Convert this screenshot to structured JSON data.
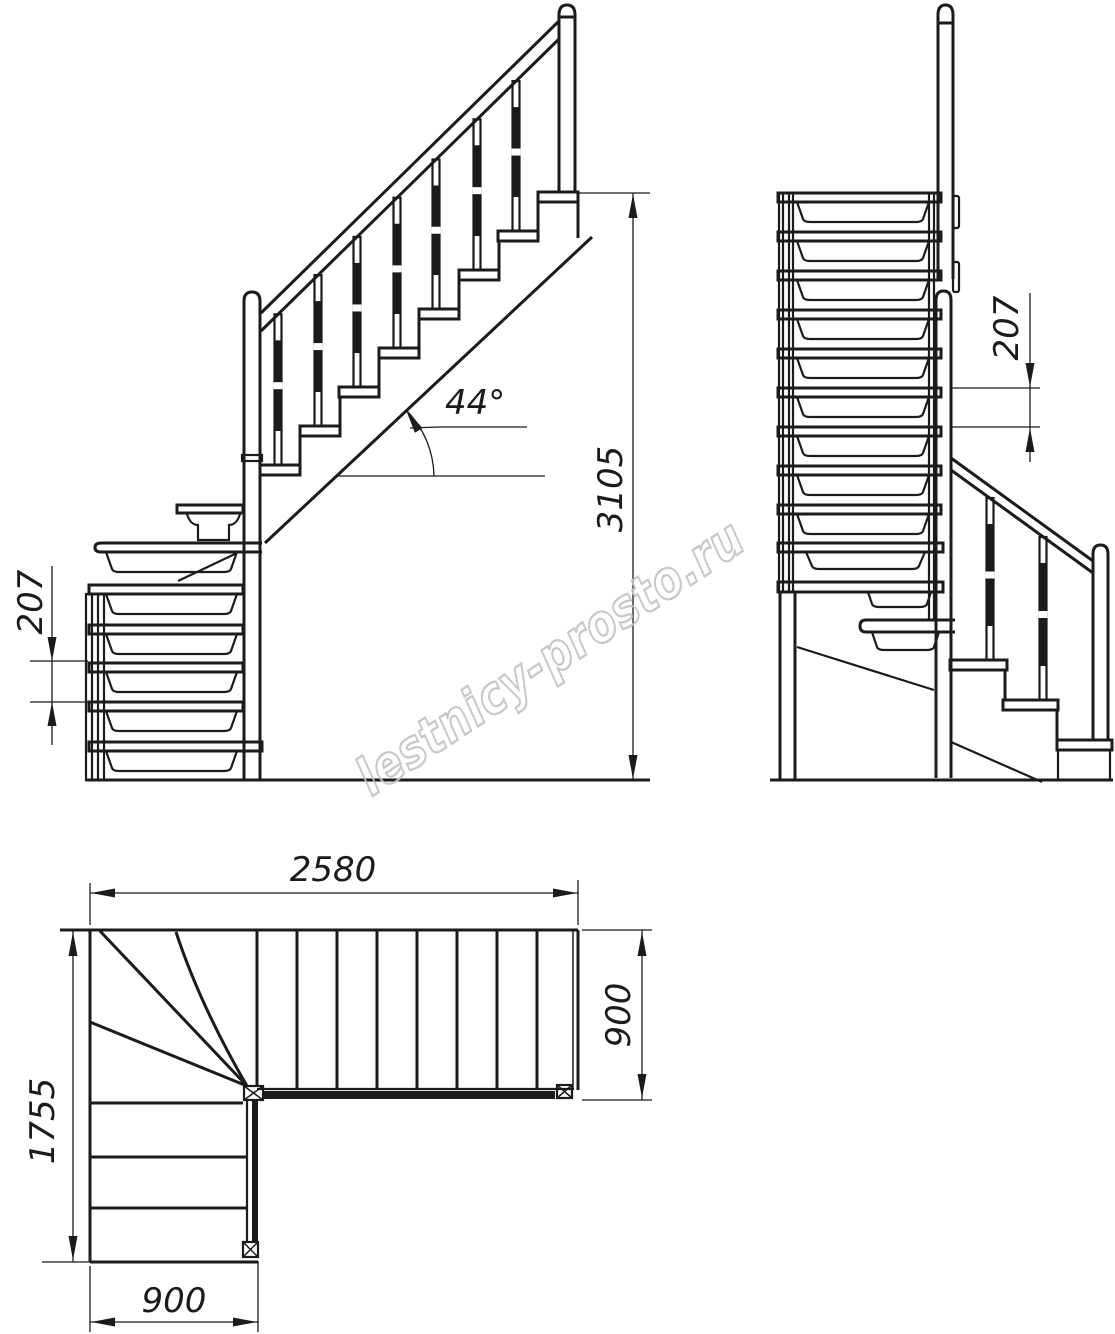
{
  "watermark": {
    "text": "lestnicy-prosto.ru"
  },
  "views": {
    "front": {
      "angle_label": "44°",
      "total_height_label": "3105",
      "riser_height_label": "207"
    },
    "side": {
      "riser_height_label": "207"
    },
    "plan": {
      "total_run_label": "2580",
      "upper_flight_width_label": "900",
      "total_depth_label": "1755",
      "lower_flight_width_label": "900"
    }
  }
}
